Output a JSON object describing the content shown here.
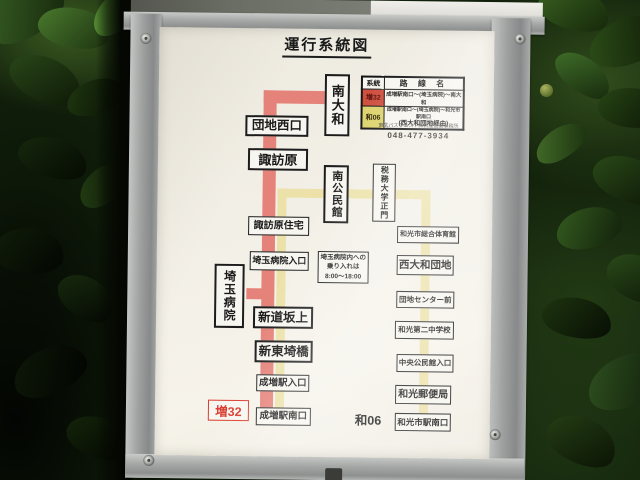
{
  "title": "運行系統図",
  "legend": {
    "col_route": "系統",
    "col_name": "路 線 名",
    "row1": {
      "route": "増32",
      "name": "成増駅南口〜(埼玉病院)〜南大和"
    },
    "row2": {
      "route": "和06",
      "name": "成増駅南口〜(埼玉病院)〜和光市駅南口",
      "name_sub": "(西大和団地経由)"
    }
  },
  "operator": "東武バスウエスト㈱新座営業事務所",
  "phone": "048-477-3934",
  "note": {
    "line1": "埼玉病院内への",
    "line2": "乗り入れは",
    "line3": "8:00〜18:00"
  },
  "labels": {
    "masu32": "増32",
    "wa06": "和06"
  },
  "stations": {
    "minami_yamato": "南大和",
    "danchi_nishiguchi": "団地西口",
    "suwahara": "諏訪原",
    "minami_kominkan": "南公民館",
    "zeimu_daigaku_seimon": "税務大学正門",
    "suwahara_jutaku": "諏訪原住宅",
    "saitama_byoin_iriguchi": "埼玉病院入口",
    "saitama_byoin": "埼玉病院",
    "shindo_sakaue": "新道坂上",
    "shin_tosaki_bashi": "新東埼橋",
    "narimasu_eki_iriguchi": "成増駅入口",
    "narimasu_eki_minamiguchi": "成増駅南口",
    "wakoshi_sogo_taiikukan": "和光市総合体育館",
    "nishi_yamato_danchi": "西大和団地",
    "danchi_center_mae": "団地センター前",
    "wako_daini_chugakko": "和光第二中学校",
    "chuo_kominkan_iriguchi": "中央公民館入口",
    "wako_yubinkyoku": "和光郵便局",
    "wakoshi_eki_minamiguchi": "和光市駅南口"
  },
  "colors": {
    "red_line": "#e5837a",
    "yellow_line": "#ece2a9",
    "legend_red_bg": "#d05040",
    "legend_yellow_bg": "#ddd36e",
    "label_red": "#d93a2e"
  }
}
